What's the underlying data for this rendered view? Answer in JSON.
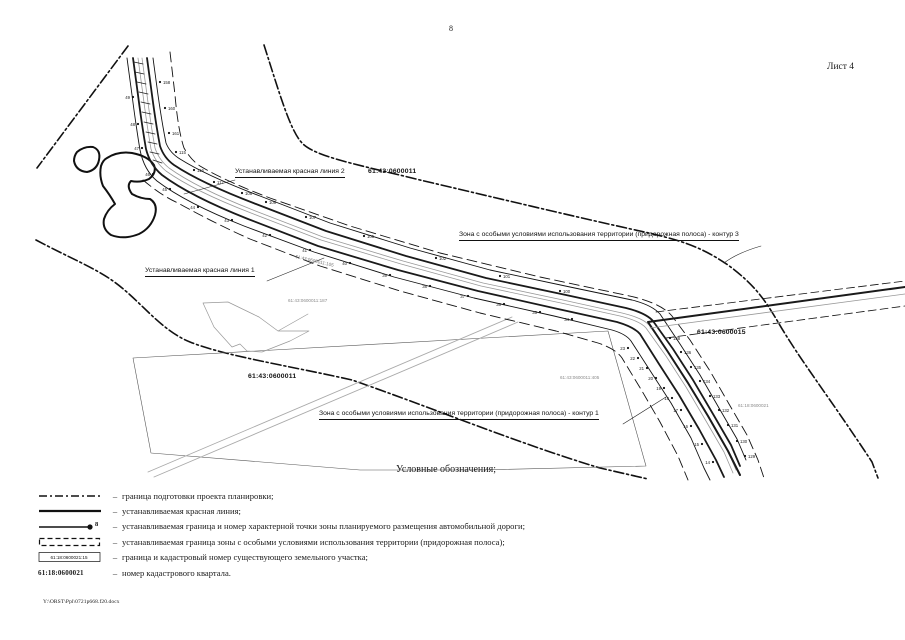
{
  "colors": {
    "ink": "#1a1a1a",
    "muted": "#999999"
  },
  "page": {
    "number": "8",
    "sheet_label": "Лист 4",
    "footer_path": "Y:\\ORST\\Ppl\\0721p668.f20.docx"
  },
  "map": {
    "annotations": {
      "red_line_2": "Устанавливаемая красная линия 2",
      "red_line_1": "Устанавливаемая красная линия 1",
      "zone_contour_3": "Зона с особыми условиями использования территории (придорожная полоса) - контур 3",
      "zone_contour_1": "Зона с особыми условиями использования территории (придорожная полоса) - контур 1",
      "quarter_top": "61:43:0600011",
      "quarter_mid": "61:43:0600011",
      "quarter_east": "61:43:0600015",
      "parcel_small_1": "61:43:0600011:187",
      "parcel_small_2": "61:43:0600011:105",
      "parcel_small_3": "61:43:0600011:405",
      "parcel_small_4": "61:18:0600021"
    },
    "points": [
      {
        "n": "49",
        "x": 133,
        "y": 97,
        "dx": -3
      },
      {
        "n": "48",
        "x": 138,
        "y": 124,
        "dx": -3
      },
      {
        "n": "47",
        "x": 142,
        "y": 148,
        "dx": -3
      },
      {
        "n": "46",
        "x": 153,
        "y": 174,
        "dx": -3
      },
      {
        "n": "45",
        "x": 170,
        "y": 189,
        "dx": -3
      },
      {
        "n": "44",
        "x": 198,
        "y": 207,
        "dx": -3
      },
      {
        "n": "43",
        "x": 232,
        "y": 220,
        "dx": -3
      },
      {
        "n": "42",
        "x": 270,
        "y": 235,
        "dx": -3
      },
      {
        "n": "41",
        "x": 310,
        "y": 250,
        "dx": -3
      },
      {
        "n": "40",
        "x": 350,
        "y": 263,
        "dx": -3
      },
      {
        "n": "39",
        "x": 390,
        "y": 275,
        "dx": -3
      },
      {
        "n": "38",
        "x": 430,
        "y": 286,
        "dx": -3
      },
      {
        "n": "37",
        "x": 468,
        "y": 296,
        "dx": -3
      },
      {
        "n": "36",
        "x": 504,
        "y": 304,
        "dx": -3
      },
      {
        "n": "35",
        "x": 540,
        "y": 312,
        "dx": -3
      },
      {
        "n": "34",
        "x": 572,
        "y": 319,
        "dx": -3
      },
      {
        "n": "23",
        "x": 628,
        "y": 348,
        "dx": -3
      },
      {
        "n": "22",
        "x": 638,
        "y": 358,
        "dx": -3
      },
      {
        "n": "21",
        "x": 647,
        "y": 368,
        "dx": -3
      },
      {
        "n": "20",
        "x": 656,
        "y": 378,
        "dx": -3
      },
      {
        "n": "19",
        "x": 664,
        "y": 388,
        "dx": -3
      },
      {
        "n": "18",
        "x": 672,
        "y": 398,
        "dx": -3
      },
      {
        "n": "17",
        "x": 681,
        "y": 410,
        "dx": -3
      },
      {
        "n": "16",
        "x": 691,
        "y": 426,
        "dx": -3
      },
      {
        "n": "15",
        "x": 702,
        "y": 444,
        "dx": -3
      },
      {
        "n": "14",
        "x": 713,
        "y": 462,
        "dx": -3
      },
      {
        "n": "158",
        "x": 160,
        "y": 82,
        "dx": 3
      },
      {
        "n": "160",
        "x": 165,
        "y": 108,
        "dx": 3
      },
      {
        "n": "161",
        "x": 169,
        "y": 133,
        "dx": 3
      },
      {
        "n": "115",
        "x": 176,
        "y": 152,
        "dx": 3
      },
      {
        "n": "116",
        "x": 194,
        "y": 170,
        "dx": 3
      },
      {
        "n": "117",
        "x": 214,
        "y": 182,
        "dx": 3
      },
      {
        "n": "108",
        "x": 242,
        "y": 193,
        "dx": 3
      },
      {
        "n": "109",
        "x": 266,
        "y": 202,
        "dx": 3
      },
      {
        "n": "107",
        "x": 306,
        "y": 217,
        "dx": 3
      },
      {
        "n": "105",
        "x": 364,
        "y": 236,
        "dx": 3
      },
      {
        "n": "102",
        "x": 436,
        "y": 258,
        "dx": 3
      },
      {
        "n": "101",
        "x": 500,
        "y": 276,
        "dx": 3
      },
      {
        "n": "100",
        "x": 560,
        "y": 291,
        "dx": 3
      },
      {
        "n": "138",
        "x": 670,
        "y": 338,
        "dx": 3
      },
      {
        "n": "136",
        "x": 681,
        "y": 352,
        "dx": 3
      },
      {
        "n": "135",
        "x": 691,
        "y": 367,
        "dx": 3
      },
      {
        "n": "134",
        "x": 700,
        "y": 381,
        "dx": 3
      },
      {
        "n": "133",
        "x": 710,
        "y": 396,
        "dx": 3
      },
      {
        "n": "132",
        "x": 719,
        "y": 410,
        "dx": 3
      },
      {
        "n": "131",
        "x": 728,
        "y": 425,
        "dx": 3
      },
      {
        "n": "130",
        "x": 737,
        "y": 441,
        "dx": 3
      },
      {
        "n": "129",
        "x": 745,
        "y": 456,
        "dx": 3
      }
    ]
  },
  "legend": {
    "title": "Условные обозначения;",
    "dash": "–",
    "items": [
      {
        "text": "граница подготовки проекта планировки;"
      },
      {
        "text": "устанавливаемая красная линия;"
      },
      {
        "point_number": "8",
        "text": "устанавливаемая граница и номер характерной точки зоны планируемого размещения автомобильной дороги;"
      },
      {
        "text": "устанавливаемая граница зоны с особыми условиями использования территории (придорожная полоса);"
      },
      {
        "box_text": "61:18:0600021:15",
        "text": "граница и кадастровый номер существующего земельного участка;"
      },
      {
        "box_text": "61:18:0600021",
        "text": "номер кадастрового квартала."
      }
    ]
  }
}
